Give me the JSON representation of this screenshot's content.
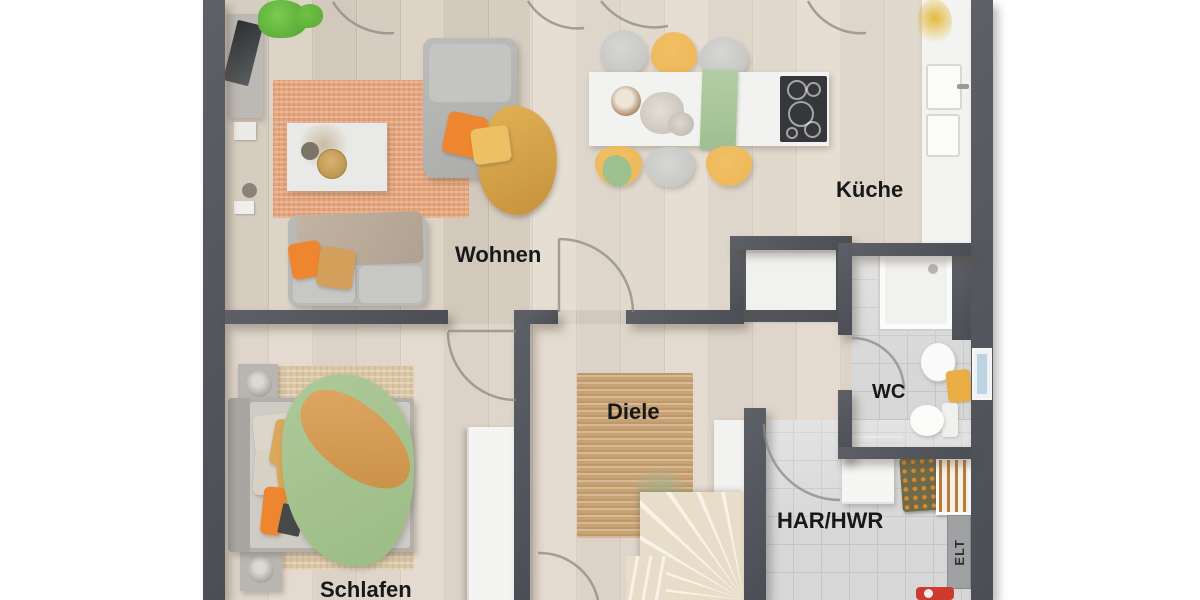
{
  "image_type": "rendered-floor-plan",
  "rooms": [
    {
      "id": "kueche",
      "label": "Küche"
    },
    {
      "id": "wohnen",
      "label": "Wohnen"
    },
    {
      "id": "diele",
      "label": "Diele"
    },
    {
      "id": "wc",
      "label": "WC"
    },
    {
      "id": "har_hwr",
      "label": "HAR/HWR"
    },
    {
      "id": "schlafen",
      "label": "Schlafen"
    },
    {
      "id": "elt",
      "label": "ELT"
    }
  ],
  "colors": {
    "wall": "#54575e",
    "wood": "#d8cec1",
    "tile": "#d7d7d7",
    "rug_orange": "#e5a47c",
    "rug_jute": "#c8a273",
    "rug_beige": "#dbc7a6",
    "accent_orange": "#ed862f",
    "accent_yellow": "#ecb655",
    "accent_green": "#a6c493",
    "window": "#bcd4e2",
    "label": "#17181a",
    "background": "#ffffff"
  }
}
